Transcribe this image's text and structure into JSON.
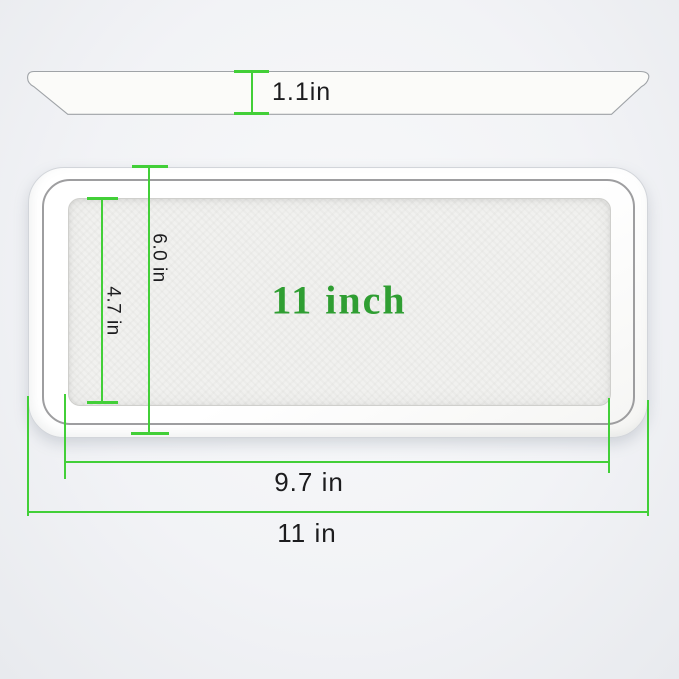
{
  "diagram": {
    "type": "product-dimension-diagram",
    "product": "rectangular white tray",
    "side_view": {
      "dim_height": "1.1in"
    },
    "top_view": {
      "label_center": "11 inch",
      "dim_outer_height": "6.0 in",
      "dim_inner_height": "4.7 in",
      "dim_inner_width": "9.7 in",
      "dim_outer_width": "11 in"
    },
    "colors": {
      "dimension_line": "#42cf38",
      "center_label_green": "#2f9e32",
      "label_text": "#1c1c1e",
      "tray_fill": "#fcfcfb",
      "background_edge": "#e8eaee"
    }
  }
}
